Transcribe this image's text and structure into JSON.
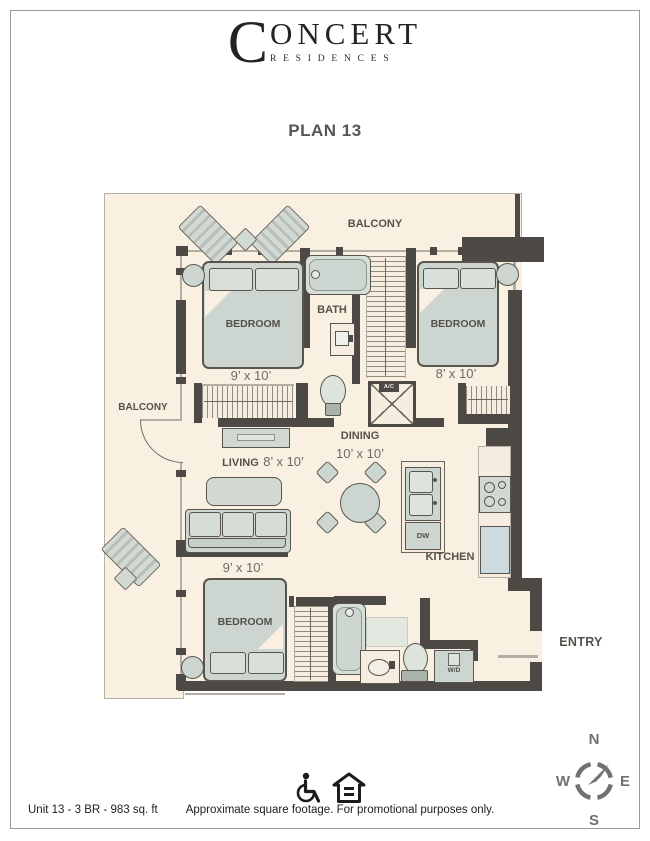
{
  "brand": {
    "initial": "C",
    "rest": "ONCERT",
    "subtitle": "RESIDENCES"
  },
  "plan_title": "PLAN 13",
  "rooms": {
    "balcony_top": "BALCONY",
    "balcony_left": "BALCONY",
    "bedroom_top_left": {
      "label": "BEDROOM",
      "dims": "9’ x 10’"
    },
    "bath": "BATH",
    "bedroom_top_right": {
      "label": "BEDROOM",
      "dims": "8’ x 10’"
    },
    "living": {
      "label": "LIVING",
      "dims": "8’ x 10’"
    },
    "dining": {
      "label": "DINING",
      "dims": "10’ x 10’"
    },
    "kitchen": "KITCHEN",
    "bedroom_bottom": {
      "label": "BEDROOM",
      "dims": "9’ x 10’"
    },
    "entry": "ENTRY"
  },
  "appliances": {
    "ac": "A/C",
    "dishwasher": "DW",
    "washer_dryer": "W/D"
  },
  "compass": {
    "north": "N",
    "east": "E",
    "south": "S",
    "west": "W"
  },
  "footer": {
    "unit_info": "Unit 13 - 3 BR - 983 sq. ft",
    "disclaimer": "Approximate square footage. For promotional purposes only."
  },
  "colors": {
    "wall": "#4d4a45",
    "floor": "#faf0e2",
    "furniture": "#d2d9d3"
  }
}
